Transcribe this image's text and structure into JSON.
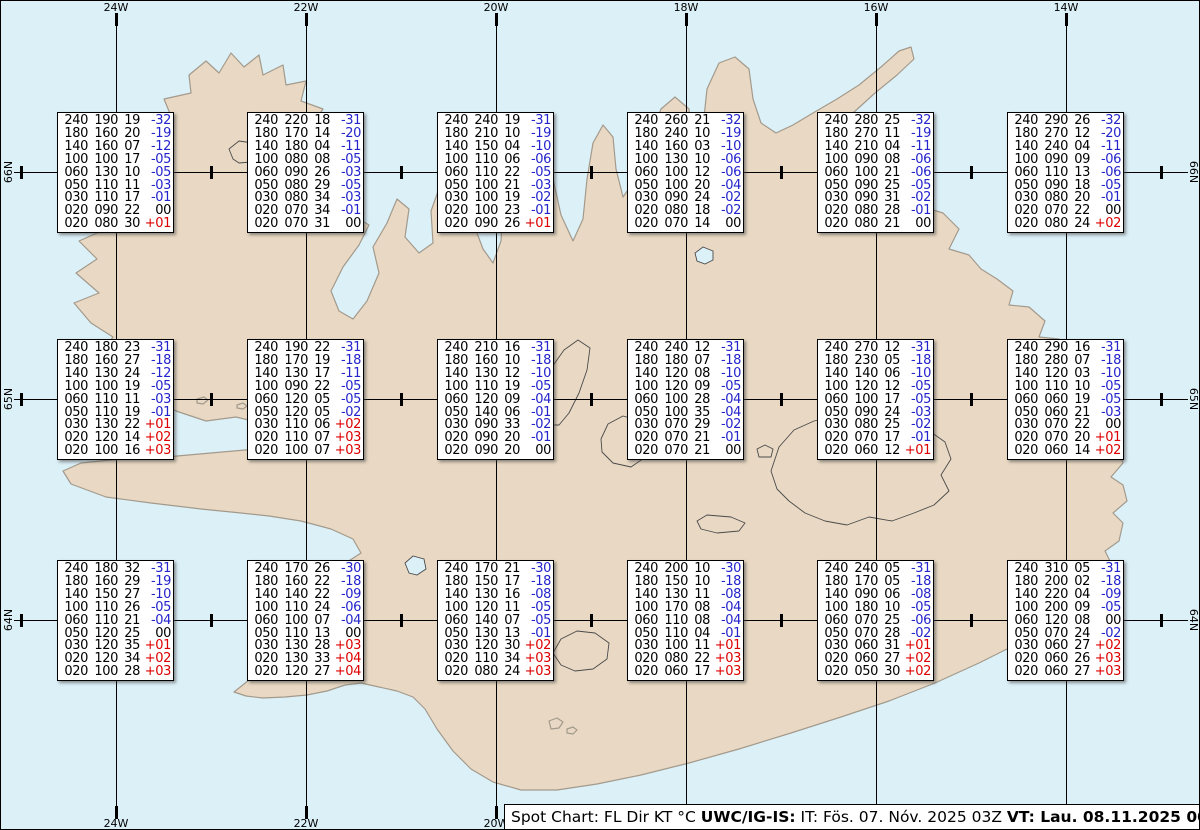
{
  "map": {
    "region_name": "iceland",
    "lon_labels": [
      "24W",
      "22W",
      "20W",
      "18W",
      "16W",
      "14W"
    ],
    "lat_labels": [
      "66N",
      "65N",
      "64N"
    ]
  },
  "columns_legend": [
    "FL",
    "Dir",
    "KT",
    "°C"
  ],
  "colors": {
    "ocean": "#dcf0f8",
    "land": "#e9d9c4",
    "coast": "#a39a8c",
    "grid": "#000000",
    "temp_negative": "#2424cc",
    "temp_positive": "#dd0000",
    "temp_zero": "#000000",
    "box_background": "#ffffff"
  },
  "status_bar": {
    "segments": [
      {
        "text": "Spot Chart: FL Dir KT °C ",
        "bold": false
      },
      {
        "text": "UWC/IG-IS:",
        "bold": true
      },
      {
        "text": " IT: Fös. 07. Nóv. 2025 03Z ",
        "bold": false
      },
      {
        "text": "VT: Lau. 08.11.2025 00Z",
        "bold": true
      },
      {
        "text": " (+21 h)",
        "bold": false
      }
    ]
  },
  "spot_boxes": [
    {
      "lon": "24W",
      "lat": "66N",
      "rows": [
        [
          "240",
          "190",
          "19",
          "-32"
        ],
        [
          "180",
          "160",
          "20",
          "-19"
        ],
        [
          "140",
          "160",
          "07",
          "-12"
        ],
        [
          "100",
          "100",
          "17",
          "-05"
        ],
        [
          "060",
          "130",
          "10",
          "-05"
        ],
        [
          "050",
          "110",
          "11",
          "-03"
        ],
        [
          "030",
          "110",
          "17",
          "-01"
        ],
        [
          "020",
          "090",
          "22",
          "00"
        ],
        [
          "020",
          "080",
          "30",
          "+01"
        ]
      ]
    },
    {
      "lon": "22W",
      "lat": "66N",
      "rows": [
        [
          "240",
          "220",
          "18",
          "-31"
        ],
        [
          "180",
          "170",
          "14",
          "-20"
        ],
        [
          "140",
          "180",
          "04",
          "-11"
        ],
        [
          "100",
          "080",
          "08",
          "-05"
        ],
        [
          "060",
          "090",
          "26",
          "-03"
        ],
        [
          "050",
          "080",
          "29",
          "-05"
        ],
        [
          "030",
          "080",
          "34",
          "-03"
        ],
        [
          "020",
          "070",
          "34",
          "-01"
        ],
        [
          "020",
          "070",
          "31",
          "00"
        ]
      ]
    },
    {
      "lon": "20W",
      "lat": "66N",
      "rows": [
        [
          "240",
          "240",
          "19",
          "-31"
        ],
        [
          "180",
          "210",
          "10",
          "-19"
        ],
        [
          "140",
          "150",
          "04",
          "-10"
        ],
        [
          "100",
          "110",
          "06",
          "-06"
        ],
        [
          "060",
          "110",
          "22",
          "-05"
        ],
        [
          "050",
          "100",
          "21",
          "-03"
        ],
        [
          "030",
          "100",
          "19",
          "-02"
        ],
        [
          "020",
          "100",
          "23",
          "-01"
        ],
        [
          "020",
          "090",
          "26",
          "+01"
        ]
      ]
    },
    {
      "lon": "18W",
      "lat": "66N",
      "rows": [
        [
          "240",
          "260",
          "21",
          "-32"
        ],
        [
          "180",
          "240",
          "10",
          "-19"
        ],
        [
          "140",
          "160",
          "03",
          "-10"
        ],
        [
          "100",
          "130",
          "10",
          "-06"
        ],
        [
          "060",
          "100",
          "12",
          "-06"
        ],
        [
          "050",
          "100",
          "20",
          "-04"
        ],
        [
          "030",
          "090",
          "24",
          "-02"
        ],
        [
          "020",
          "080",
          "18",
          "-02"
        ],
        [
          "020",
          "070",
          "14",
          "00"
        ]
      ]
    },
    {
      "lon": "16W",
      "lat": "66N",
      "rows": [
        [
          "240",
          "280",
          "25",
          "-32"
        ],
        [
          "180",
          "270",
          "11",
          "-19"
        ],
        [
          "140",
          "210",
          "04",
          "-11"
        ],
        [
          "100",
          "090",
          "08",
          "-06"
        ],
        [
          "060",
          "100",
          "21",
          "-06"
        ],
        [
          "050",
          "090",
          "25",
          "-05"
        ],
        [
          "030",
          "090",
          "31",
          "-02"
        ],
        [
          "020",
          "080",
          "28",
          "-01"
        ],
        [
          "020",
          "080",
          "21",
          "00"
        ]
      ]
    },
    {
      "lon": "14W",
      "lat": "66N",
      "rows": [
        [
          "240",
          "290",
          "26",
          "-32"
        ],
        [
          "180",
          "270",
          "12",
          "-20"
        ],
        [
          "140",
          "240",
          "04",
          "-11"
        ],
        [
          "100",
          "090",
          "09",
          "-06"
        ],
        [
          "060",
          "110",
          "13",
          "-06"
        ],
        [
          "050",
          "090",
          "18",
          "-05"
        ],
        [
          "030",
          "080",
          "20",
          "-01"
        ],
        [
          "020",
          "070",
          "22",
          "00"
        ],
        [
          "020",
          "080",
          "24",
          "+02"
        ]
      ]
    },
    {
      "lon": "24W",
      "lat": "65N",
      "rows": [
        [
          "240",
          "180",
          "23",
          "-31"
        ],
        [
          "180",
          "160",
          "27",
          "-18"
        ],
        [
          "140",
          "130",
          "24",
          "-12"
        ],
        [
          "100",
          "100",
          "19",
          "-05"
        ],
        [
          "060",
          "110",
          "11",
          "-03"
        ],
        [
          "050",
          "110",
          "19",
          "-01"
        ],
        [
          "030",
          "130",
          "22",
          "+01"
        ],
        [
          "020",
          "120",
          "14",
          "+02"
        ],
        [
          "020",
          "100",
          "16",
          "+03"
        ]
      ]
    },
    {
      "lon": "22W",
      "lat": "65N",
      "rows": [
        [
          "240",
          "190",
          "22",
          "-31"
        ],
        [
          "180",
          "170",
          "19",
          "-18"
        ],
        [
          "140",
          "130",
          "17",
          "-11"
        ],
        [
          "100",
          "090",
          "22",
          "-05"
        ],
        [
          "060",
          "120",
          "05",
          "-05"
        ],
        [
          "050",
          "120",
          "05",
          "-02"
        ],
        [
          "030",
          "110",
          "06",
          "+02"
        ],
        [
          "020",
          "110",
          "07",
          "+03"
        ],
        [
          "020",
          "100",
          "07",
          "+03"
        ]
      ]
    },
    {
      "lon": "20W",
      "lat": "65N",
      "rows": [
        [
          "240",
          "210",
          "16",
          "-31"
        ],
        [
          "180",
          "160",
          "10",
          "-18"
        ],
        [
          "140",
          "130",
          "12",
          "-10"
        ],
        [
          "100",
          "110",
          "19",
          "-05"
        ],
        [
          "060",
          "120",
          "09",
          "-04"
        ],
        [
          "050",
          "140",
          "06",
          "-01"
        ],
        [
          "030",
          "090",
          "33",
          "-02"
        ],
        [
          "020",
          "090",
          "20",
          "-01"
        ],
        [
          "020",
          "090",
          "20",
          "00"
        ]
      ]
    },
    {
      "lon": "18W",
      "lat": "65N",
      "rows": [
        [
          "240",
          "240",
          "12",
          "-31"
        ],
        [
          "180",
          "180",
          "07",
          "-18"
        ],
        [
          "140",
          "120",
          "08",
          "-10"
        ],
        [
          "100",
          "120",
          "09",
          "-05"
        ],
        [
          "060",
          "100",
          "28",
          "-04"
        ],
        [
          "050",
          "100",
          "35",
          "-04"
        ],
        [
          "030",
          "070",
          "29",
          "-02"
        ],
        [
          "020",
          "070",
          "21",
          "-01"
        ],
        [
          "020",
          "070",
          "21",
          "00"
        ]
      ]
    },
    {
      "lon": "16W",
      "lat": "65N",
      "rows": [
        [
          "240",
          "270",
          "12",
          "-31"
        ],
        [
          "180",
          "230",
          "05",
          "-18"
        ],
        [
          "140",
          "140",
          "06",
          "-10"
        ],
        [
          "100",
          "120",
          "12",
          "-05"
        ],
        [
          "060",
          "100",
          "17",
          "-05"
        ],
        [
          "050",
          "090",
          "24",
          "-03"
        ],
        [
          "030",
          "080",
          "25",
          "-02"
        ],
        [
          "020",
          "070",
          "17",
          "-01"
        ],
        [
          "020",
          "060",
          "12",
          "+01"
        ]
      ]
    },
    {
      "lon": "14W",
      "lat": "65N",
      "rows": [
        [
          "240",
          "290",
          "16",
          "-31"
        ],
        [
          "180",
          "280",
          "07",
          "-18"
        ],
        [
          "140",
          "120",
          "03",
          "-10"
        ],
        [
          "100",
          "110",
          "10",
          "-05"
        ],
        [
          "060",
          "060",
          "19",
          "-05"
        ],
        [
          "050",
          "060",
          "21",
          "-03"
        ],
        [
          "030",
          "070",
          "22",
          "00"
        ],
        [
          "020",
          "070",
          "20",
          "+01"
        ],
        [
          "020",
          "060",
          "14",
          "+02"
        ]
      ]
    },
    {
      "lon": "24W",
      "lat": "64N",
      "rows": [
        [
          "240",
          "180",
          "32",
          "-31"
        ],
        [
          "180",
          "160",
          "29",
          "-19"
        ],
        [
          "140",
          "150",
          "27",
          "-10"
        ],
        [
          "100",
          "110",
          "26",
          "-05"
        ],
        [
          "060",
          "110",
          "21",
          "-04"
        ],
        [
          "050",
          "120",
          "25",
          "00"
        ],
        [
          "030",
          "120",
          "35",
          "+01"
        ],
        [
          "020",
          "120",
          "34",
          "+02"
        ],
        [
          "020",
          "100",
          "28",
          "+03"
        ]
      ]
    },
    {
      "lon": "22W",
      "lat": "64N",
      "rows": [
        [
          "240",
          "170",
          "26",
          "-30"
        ],
        [
          "180",
          "160",
          "22",
          "-18"
        ],
        [
          "140",
          "140",
          "22",
          "-09"
        ],
        [
          "100",
          "110",
          "24",
          "-06"
        ],
        [
          "060",
          "100",
          "07",
          "-04"
        ],
        [
          "050",
          "110",
          "13",
          "00"
        ],
        [
          "030",
          "130",
          "28",
          "+03"
        ],
        [
          "020",
          "130",
          "33",
          "+04"
        ],
        [
          "020",
          "120",
          "27",
          "+04"
        ]
      ]
    },
    {
      "lon": "20W",
      "lat": "64N",
      "rows": [
        [
          "240",
          "170",
          "21",
          "-30"
        ],
        [
          "180",
          "150",
          "17",
          "-18"
        ],
        [
          "140",
          "130",
          "16",
          "-08"
        ],
        [
          "100",
          "120",
          "11",
          "-05"
        ],
        [
          "060",
          "140",
          "07",
          "-05"
        ],
        [
          "050",
          "130",
          "13",
          "-01"
        ],
        [
          "030",
          "120",
          "30",
          "+02"
        ],
        [
          "020",
          "110",
          "34",
          "+03"
        ],
        [
          "020",
          "080",
          "24",
          "+03"
        ]
      ]
    },
    {
      "lon": "18W",
      "lat": "64N",
      "rows": [
        [
          "240",
          "200",
          "10",
          "-30"
        ],
        [
          "180",
          "150",
          "10",
          "-18"
        ],
        [
          "140",
          "130",
          "11",
          "-08"
        ],
        [
          "100",
          "170",
          "08",
          "-04"
        ],
        [
          "060",
          "110",
          "08",
          "-04"
        ],
        [
          "050",
          "110",
          "04",
          "-01"
        ],
        [
          "030",
          "100",
          "11",
          "+01"
        ],
        [
          "020",
          "080",
          "22",
          "+03"
        ],
        [
          "020",
          "060",
          "17",
          "+03"
        ]
      ]
    },
    {
      "lon": "16W",
      "lat": "64N",
      "rows": [
        [
          "240",
          "240",
          "05",
          "-31"
        ],
        [
          "180",
          "170",
          "05",
          "-18"
        ],
        [
          "140",
          "090",
          "06",
          "-08"
        ],
        [
          "100",
          "180",
          "10",
          "-05"
        ],
        [
          "060",
          "070",
          "25",
          "-06"
        ],
        [
          "050",
          "070",
          "28",
          "-02"
        ],
        [
          "030",
          "060",
          "31",
          "+01"
        ],
        [
          "020",
          "060",
          "27",
          "+02"
        ],
        [
          "020",
          "050",
          "30",
          "+02"
        ]
      ]
    },
    {
      "lon": "14W",
      "lat": "64N",
      "rows": [
        [
          "240",
          "310",
          "05",
          "-31"
        ],
        [
          "180",
          "200",
          "02",
          "-18"
        ],
        [
          "140",
          "220",
          "04",
          "-09"
        ],
        [
          "100",
          "200",
          "09",
          "-05"
        ],
        [
          "060",
          "120",
          "08",
          "00"
        ],
        [
          "050",
          "070",
          "24",
          "-02"
        ],
        [
          "030",
          "060",
          "27",
          "+02"
        ],
        [
          "020",
          "060",
          "26",
          "+03"
        ],
        [
          "020",
          "060",
          "27",
          "+03"
        ]
      ]
    }
  ]
}
